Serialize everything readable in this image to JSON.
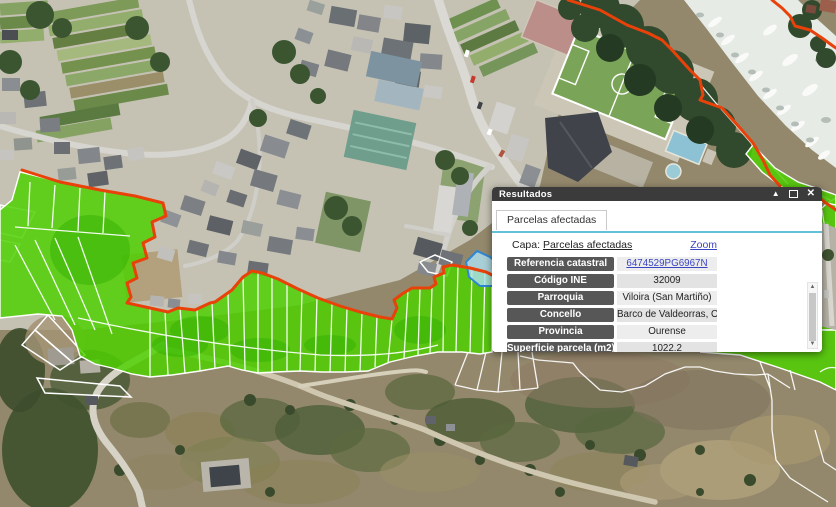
{
  "dialog": {
    "title": "Resultados",
    "controls": {
      "collapse_icon": "▲",
      "close_icon": "✕"
    },
    "tab": "Parcelas afectadas",
    "layer_label": "Capa:",
    "layer_link": "Parcelas afectadas",
    "zoom_link": "Zoom",
    "rows": [
      {
        "label": "Referencia catastral",
        "value": "6474529PG6967N",
        "link": true
      },
      {
        "label": "Código INE",
        "value": "32009"
      },
      {
        "label": "Parroquia",
        "value": "Viloira (San Martiño)"
      },
      {
        "label": "Concello",
        "value": "Barco de Valdeorras, O"
      },
      {
        "label": "Provincia",
        "value": "Ourense"
      },
      {
        "label": "Superficie parcela (m2)",
        "value": "1022.2"
      }
    ],
    "scrollbar": {
      "up_icon": "▲",
      "down_icon": "▼"
    }
  },
  "map": {
    "description": "Aerial orthophoto of Viloira / O Barco de Valdeorras with affected cadastral parcels highlighted",
    "colors": {
      "affected_parcel_fill": "#4ed000",
      "boundary_line": "#e8420a",
      "parcel_outline": "#ffffff",
      "selected_parcel_fill": "#aee0f2",
      "selected_parcel_stroke": "#2e86d4",
      "link_blue": "#3a45c2",
      "label_bg": "#575757",
      "titlebar_bg": "#3b3b3b",
      "tab_underline": "#62c0d8"
    }
  }
}
